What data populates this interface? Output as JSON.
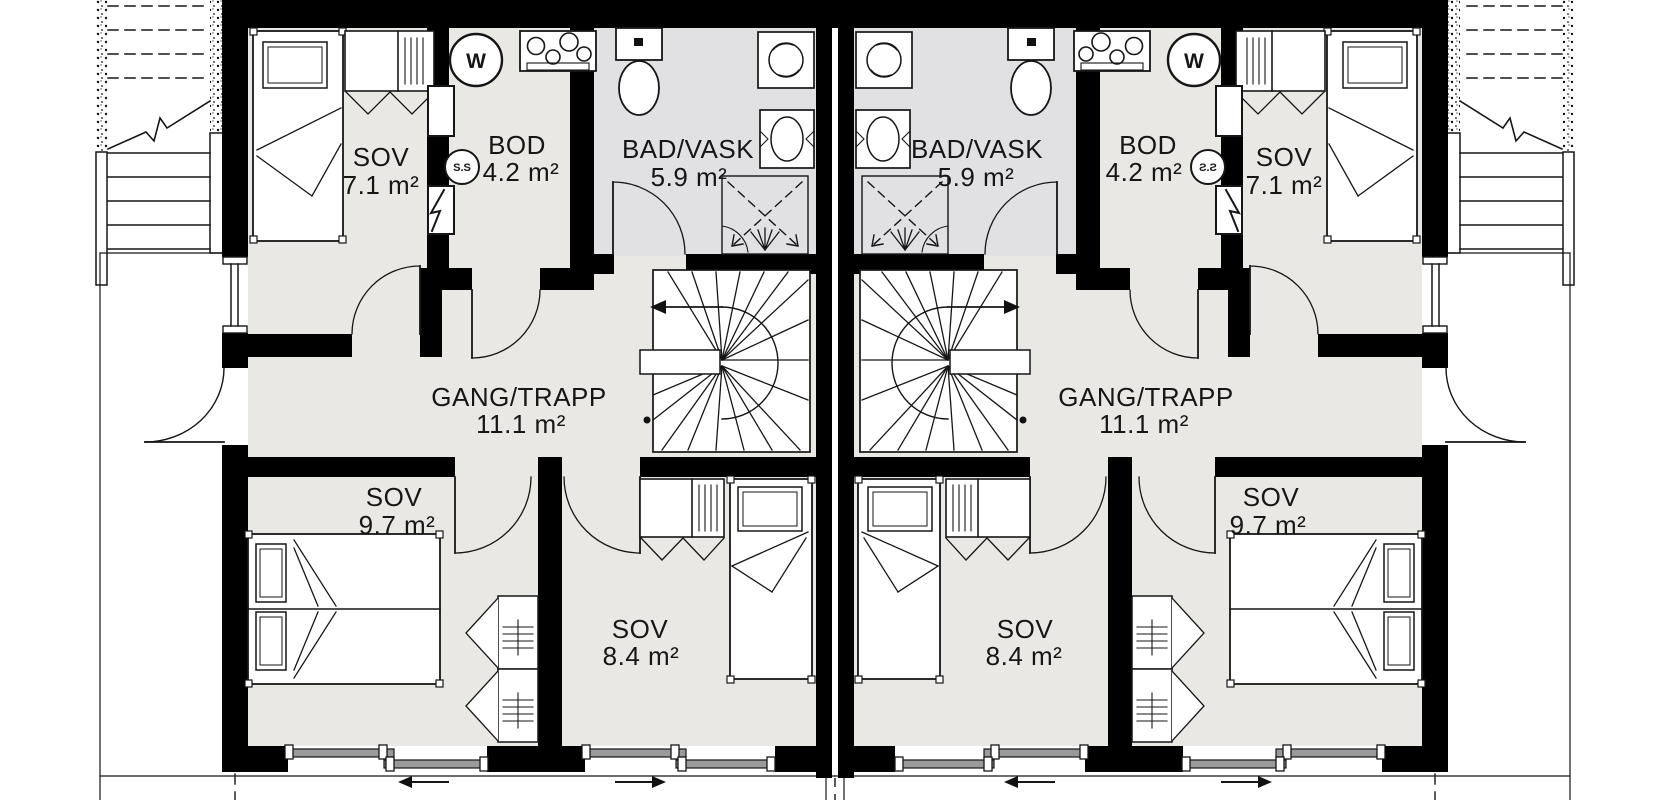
{
  "plan": {
    "units": [
      {
        "label": "left-unit",
        "rooms": [
          {
            "name": "SOV",
            "area": "7.1 m²"
          },
          {
            "name": "BOD",
            "area": "4.2 m²"
          },
          {
            "name": "BAD/VASK",
            "area": "5.9 m²"
          },
          {
            "name": "GANG/TRAPP",
            "area": "11.1 m²"
          },
          {
            "name": "SOV",
            "area": "9.7 m²"
          },
          {
            "name": "SOV",
            "area": "8.4 m²"
          }
        ]
      },
      {
        "label": "right-unit",
        "rooms": [
          {
            "name": "SOV",
            "area": "7.1 m²"
          },
          {
            "name": "BOD",
            "area": "4.2 m²"
          },
          {
            "name": "BAD/VASK",
            "area": "5.9 m²"
          },
          {
            "name": "GANG/TRAPP",
            "area": "11.1 m²"
          },
          {
            "name": "SOV",
            "area": "9.7 m²"
          },
          {
            "name": "SOV",
            "area": "8.4 m²"
          }
        ]
      }
    ],
    "symbols": {
      "water_heater": "W",
      "fuse_cabinet": "S.S"
    },
    "colors": {
      "wall": "#000000",
      "floor": "#e9e8e4",
      "bath_floor": "#e1e1e4",
      "line": "#161616"
    }
  }
}
